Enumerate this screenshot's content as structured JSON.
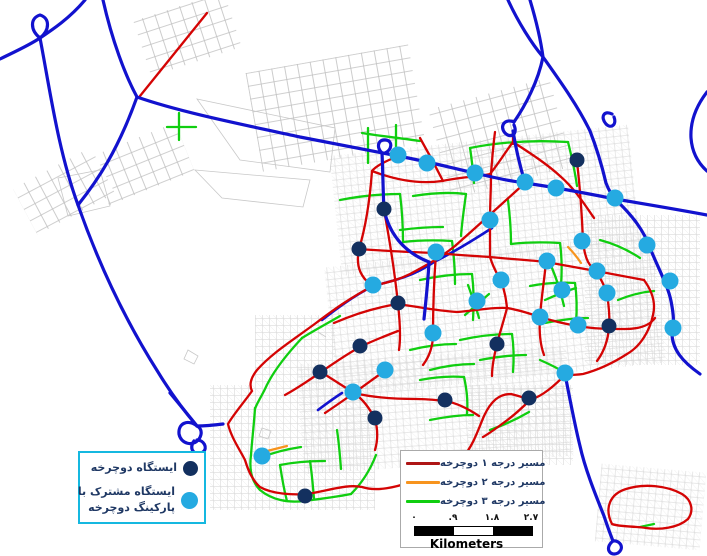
{
  "legend_stations": {
    "station_label": "ایستگاه دوچرخه",
    "shared_label_line1": "ایستگاه مشترک با",
    "shared_label_line2": "پارکینگ دوچرخه",
    "station_dot_color": "#13305F",
    "shared_dot_color": "#25AAE1",
    "border_color": "#15b8e0"
  },
  "legend_routes": {
    "items": [
      {
        "label": "مسیر درجه ۱ دوچرخه",
        "color": "#AE1616"
      },
      {
        "label": "مسیر درجه ۲ دوچرخه",
        "color": "#F7941E"
      },
      {
        "label": "مسیر درجه ۳ دوچرخه",
        "color": "#10CE10"
      }
    ]
  },
  "scalebar": {
    "labels": [
      "۰",
      ".۹",
      "۱.۸",
      "۲.۷"
    ],
    "label_offsets": [
      8,
      47,
      86,
      125
    ],
    "segments": [
      {
        "width": 39,
        "color": "#000000"
      },
      {
        "width": 39,
        "color": "#ffffff"
      },
      {
        "width": 39,
        "color": "#000000"
      }
    ],
    "unit": "Kilometers"
  },
  "map": {
    "styles": {
      "blue": {
        "color": "#1212CE",
        "width": 3.2
      },
      "blue_under": {
        "color": "#1212CE",
        "width": 2.6
      },
      "red": {
        "color": "#D40404",
        "width": 2.3
      },
      "green": {
        "color": "#10CE10",
        "width": 2.3
      },
      "orange": {
        "color": "#F7941E",
        "width": 2.2
      },
      "outline": {
        "color": "#c8c8c8",
        "width": 0.8
      },
      "station_dark": {
        "color": "#13305F",
        "r": 7.5
      },
      "station_light": {
        "color": "#25AAE1",
        "r": 8.5
      }
    },
    "gray_patches": [
      {
        "kind": "blocks",
        "x": 140,
        "y": 5,
        "w": 95,
        "h": 58,
        "rot": -18
      },
      {
        "kind": "blocks",
        "x": 253,
        "y": 58,
        "w": 165,
        "h": 100,
        "rot": -10
      },
      {
        "kind": "blocks",
        "x": 96,
        "y": 138,
        "w": 92,
        "h": 52,
        "rot": -22
      },
      {
        "kind": "blocks",
        "x": 20,
        "y": 165,
        "w": 88,
        "h": 52,
        "rot": -28
      },
      {
        "kind": "blocks",
        "x": 438,
        "y": 92,
        "w": 125,
        "h": 92,
        "rot": -15
      },
      {
        "kind": "fine",
        "x": 335,
        "y": 140,
        "w": 300,
        "h": 120,
        "rot": -6
      },
      {
        "kind": "fine",
        "x": 330,
        "y": 250,
        "w": 330,
        "h": 130,
        "rot": -6
      },
      {
        "kind": "fine",
        "x": 585,
        "y": 215,
        "w": 115,
        "h": 150,
        "rot": 0
      },
      {
        "kind": "fine",
        "x": 300,
        "y": 355,
        "w": 270,
        "h": 110,
        "rot": -4
      },
      {
        "kind": "fine",
        "x": 210,
        "y": 385,
        "w": 165,
        "h": 125,
        "rot": 0
      },
      {
        "kind": "fine",
        "x": 255,
        "y": 315,
        "w": 80,
        "h": 70,
        "rot": 0
      },
      {
        "kind": "fine",
        "x": 468,
        "y": 385,
        "w": 105,
        "h": 80,
        "rot": 0
      },
      {
        "kind": "fine",
        "x": 598,
        "y": 468,
        "w": 105,
        "h": 78,
        "rot": 5
      }
    ],
    "gray_outlines": [
      "M197,99 L335,128 L330,172 L240,160 Z",
      "M195,170 L310,180 L303,207 L222,198 Z",
      "M58,178 L100,170 L110,206 L68,216 Z",
      "M188,350 l10,6 l-4,8 l-10,-5 Z",
      "M262,428 l9,3 l-3,8 l-9,-3 Z",
      "M318,332 l8,5"
    ],
    "roads": {
      "green": [
        "M167,127 L196,127",
        "M179,113 L179,140",
        "M362,133 C380,136 400,138 420,141",
        "M368,128 L368,163",
        "M396,125 L396,152",
        "M340,200 C360,196 380,194 400,194",
        "M400,194 C402,210 403,226 403,242",
        "M403,242 C420,240 436,240 452,241",
        "M452,241 C454,256 455,270 455,284",
        "M420,280 C438,276 455,274 472,274",
        "M472,274 C474,290 474,305 473,320",
        "M413,196 C432,193 450,192 466,194",
        "M466,194 C464,208 462,222 461,236",
        "M508,200 C510,216 511,230 511,244",
        "M511,244 C528,242 544,242 560,243",
        "M560,243 C562,258 562,272 561,286",
        "M545,300 C556,295 566,291 576,288",
        "M552,268 C557,280 561,293 564,306",
        "M530,286 C545,283 560,282 575,283",
        "M575,283 C577,297 577,310 576,323",
        "M545,323 C560,320 574,318 588,318",
        "M600,240 C615,244 628,250 640,258",
        "M618,300 C630,295 642,292 654,291",
        "M460,340 C478,336 495,334 512,334",
        "M512,334 C514,348 514,360 513,372",
        "M480,360 C496,357 511,355 526,355",
        "M410,350 C426,346 441,344 456,344",
        "M430,370 C445,366 460,364 474,364",
        "M400,230 C415,228 429,227 443,227",
        "M465,315 C473,308 481,301 489,294",
        "M468,285 C472,296 476,307 479,318",
        "M470,148 C500,142 535,140 568,142",
        "M568,142 C572,158 575,172 577,186",
        "M470,148 C472,160 473,172 474,183",
        "M302,338 C287,354 273,371 265,389 C260,399 256,405 255,409",
        "M302,338 C315,330 328,323 340,316",
        "M255,408 C254,425 252,440 251,455",
        "M251,455 C249,470 252,482 260,490 C272,500 288,503 304,501 C320,499 336,497 351,494",
        "M351,494 C363,482 371,468 376,455",
        "M280,465 C295,462 310,461 325,461",
        "M280,465 C282,478 284,490 287,501",
        "M310,461 C312,474 313,487 314,499",
        "M337,430 C339,443 340,456 341,469",
        "M262,457 C275,452 288,449 301,447",
        "M420,380 C435,377 450,376 464,377",
        "M464,377 C467,390 468,402 467,414",
        "M430,420 C445,417 459,415 473,415",
        "M490,430 C504,425 517,419 529,412",
        "M540,360 C549,364 558,368 565,373",
        "M640,527 L654,524"
      ],
      "orange": [
        "M568,247 C573,252 577,257 581,263",
        "M267,451 L287,446"
      ],
      "blue_under": [
        "M492,228 C472,241 452,253 434,262 C412,277 392,281 373,286 C352,297 336,309 322,320",
        "M318,410 C326,404 334,398 342,393"
      ],
      "red": [
        "M207,13 L140,96",
        "M398,156 C384,162 376,166 372,171 C370,198 366,226 359,249 C355,268 362,278 372,286",
        "M372,171 C398,181 422,184 442,181 C466,176 480,177 490,174 C499,163 506,151 513,142 C530,153 547,164 560,176 C575,189 585,205 594,218",
        "M513,133 L513,144",
        "M359,249 C384,251 410,252 435,253 C458,255 474,256 490,257 C509,259 528,260 546,262 C563,265 580,268 596,271 C612,274 628,277 644,280",
        "M525,183 C505,201 480,224 455,246 C440,258 425,266 410,274 C396,281 384,283 373,286 C351,297 332,311 316,323 C293,340 272,353 257,370 C249,380 250,387 252,391 C245,401 233,415 228,424 C231,437 240,450 245,460 C248,470 252,480 260,487 C272,494 292,495 307,494 C331,490 347,484 362,487 C377,492 396,487 411,482 C431,475 449,468 463,457 C473,446 478,430 484,416 C491,401 499,394 511,394 C519,396 525,398 530,400 C543,396 555,385 565,375",
        "M577,161 C580,188 582,215 583,241 C585,261 590,267 597,271",
        "M384,210 C390,242 395,275 398,304 C400,322 401,337 399,350",
        "M436,253 C434,280 433,306 433,334 C433,347 429,357 423,365",
        "M490,220 C490,232 490,245 490,257 C494,270 498,275 501,281 C505,292 506,299 507,308",
        "M495,132 C493,147 492,161 491,174 C491,190 490,205 490,220",
        "M546,262 C544,282 541,301 540,317 C539,331 540,344 544,355",
        "M596,271 C601,279 605,287 607,294 C609,307 610,317 609,327 C608,341 603,353 597,361",
        "M334,323 C357,313 378,307 398,304 C419,307 438,311 457,312 C474,311 490,307 507,308 C520,310 531,314 540,317 C553,321 565,324 578,326 C594,329 610,329 625,329 C640,329 650,325 655,318",
        "M644,280 C652,291 656,303 653,315 C650,330 641,346 627,354 C613,363 598,370 583,374 C576,375 570,375 565,375",
        "M398,331 C385,336 372,341 360,347 C347,354 334,363 321,372 C308,381 296,389 285,395",
        "M321,372 C332,379 343,386 354,393 C364,400 370,409 375,419 C378,430 378,440 375,450",
        "M386,370 C376,377 365,385 354,393 C344,400 334,407 325,413",
        "M354,393 C375,398 396,399 416,399 C426,399 436,400 445,401 C458,403 470,410 479,416",
        "M530,400 C521,409 513,416 506,421 C498,427 490,433 483,437",
        "M420,138 C428,152 436,167 443,181",
        "M507,308 C504,320 500,332 497,344 C494,356 492,366 492,376",
        "M612,524 C604,508 610,494 626,489 C645,483 668,486 682,494 C692,500 694,511 688,519 C678,528 660,530 646,528 C633,526 620,527 612,524"
      ],
      "blue": [
        "M85,0 C70,18 52,30 40,38 C28,46 12,53 0,59",
        "M40,38 C30,30 30,18 40,15 C50,18 50,30 40,38",
        "M40,38 C50,90 58,150 78,205 C98,262 125,320 158,372 C172,395 185,412 197,426",
        "M103,0 C112,40 125,75 137,97 C118,150 98,180 78,205",
        "M137,97 C180,112 240,124 300,137 C340,145 368,150 398,156 C430,162 452,168 475,173 C495,178 510,181 525,183 C546,186 580,192 615,199 C645,204 675,209 707,215",
        "M382,153 C376,147 378,139 386,140 C393,141 392,150 385,153",
        "M382,153 C383,173 383,192 384,210 C390,236 406,253 429,262 C428,282 426,300 424,319",
        "M508,0 C518,22 532,44 543,57 C560,81 578,106 590,131 C597,149 602,166 606,183 C609,191 612,195 615,199",
        "M612,114 C604,110 600,117 606,124 C611,129 617,125 614,117",
        "M530,0 C536,20 541,42 543,57 C538,82 525,106 514,122",
        "M514,122 C505,118 499,126 505,133 C511,139 518,134 514,125",
        "M513,131 C516,150 520,166 525,183",
        "M615,199 C633,216 644,231 650,248 C659,270 668,286 671,301 C674,316 674,323 672,331 C671,349 683,362 700,374",
        "M565,374 C570,400 575,426 580,446 C585,469 596,496 604,516 C608,528 611,536 613,541",
        "M613,541 C604,548 610,557 618,553 C625,548 620,540 613,541",
        "M707,92 C697,105 690,120 691,138 C692,152 698,163 707,171",
        "M170,393 C180,405 189,416 197,426",
        "M197,426 C188,419 178,423 179,434 C181,444 193,447 199,439 C203,433 201,428 197,426",
        "M194,441 C188,449 195,457 203,452 C208,448 204,440 197,440",
        "M197,426 C206,426 215,425 223,424"
      ]
    },
    "stations": {
      "dark": [
        [
          577,
          160
        ],
        [
          384,
          209
        ],
        [
          359,
          249
        ],
        [
          398,
          303
        ],
        [
          360,
          346
        ],
        [
          320,
          372
        ],
        [
          375,
          418
        ],
        [
          445,
          400
        ],
        [
          529,
          398
        ],
        [
          609,
          326
        ],
        [
          497,
          344
        ],
        [
          305,
          496
        ]
      ],
      "light": [
        [
          398,
          155
        ],
        [
          427,
          163
        ],
        [
          475,
          173
        ],
        [
          525,
          182
        ],
        [
          556,
          188
        ],
        [
          615,
          198
        ],
        [
          490,
          220
        ],
        [
          582,
          241
        ],
        [
          647,
          245
        ],
        [
          436,
          252
        ],
        [
          547,
          261
        ],
        [
          597,
          271
        ],
        [
          373,
          285
        ],
        [
          501,
          280
        ],
        [
          562,
          290
        ],
        [
          607,
          293
        ],
        [
          477,
          301
        ],
        [
          670,
          281
        ],
        [
          540,
          317
        ],
        [
          578,
          325
        ],
        [
          673,
          328
        ],
        [
          433,
          333
        ],
        [
          385,
          370
        ],
        [
          353,
          392
        ],
        [
          565,
          373
        ],
        [
          262,
          456
        ]
      ]
    }
  }
}
